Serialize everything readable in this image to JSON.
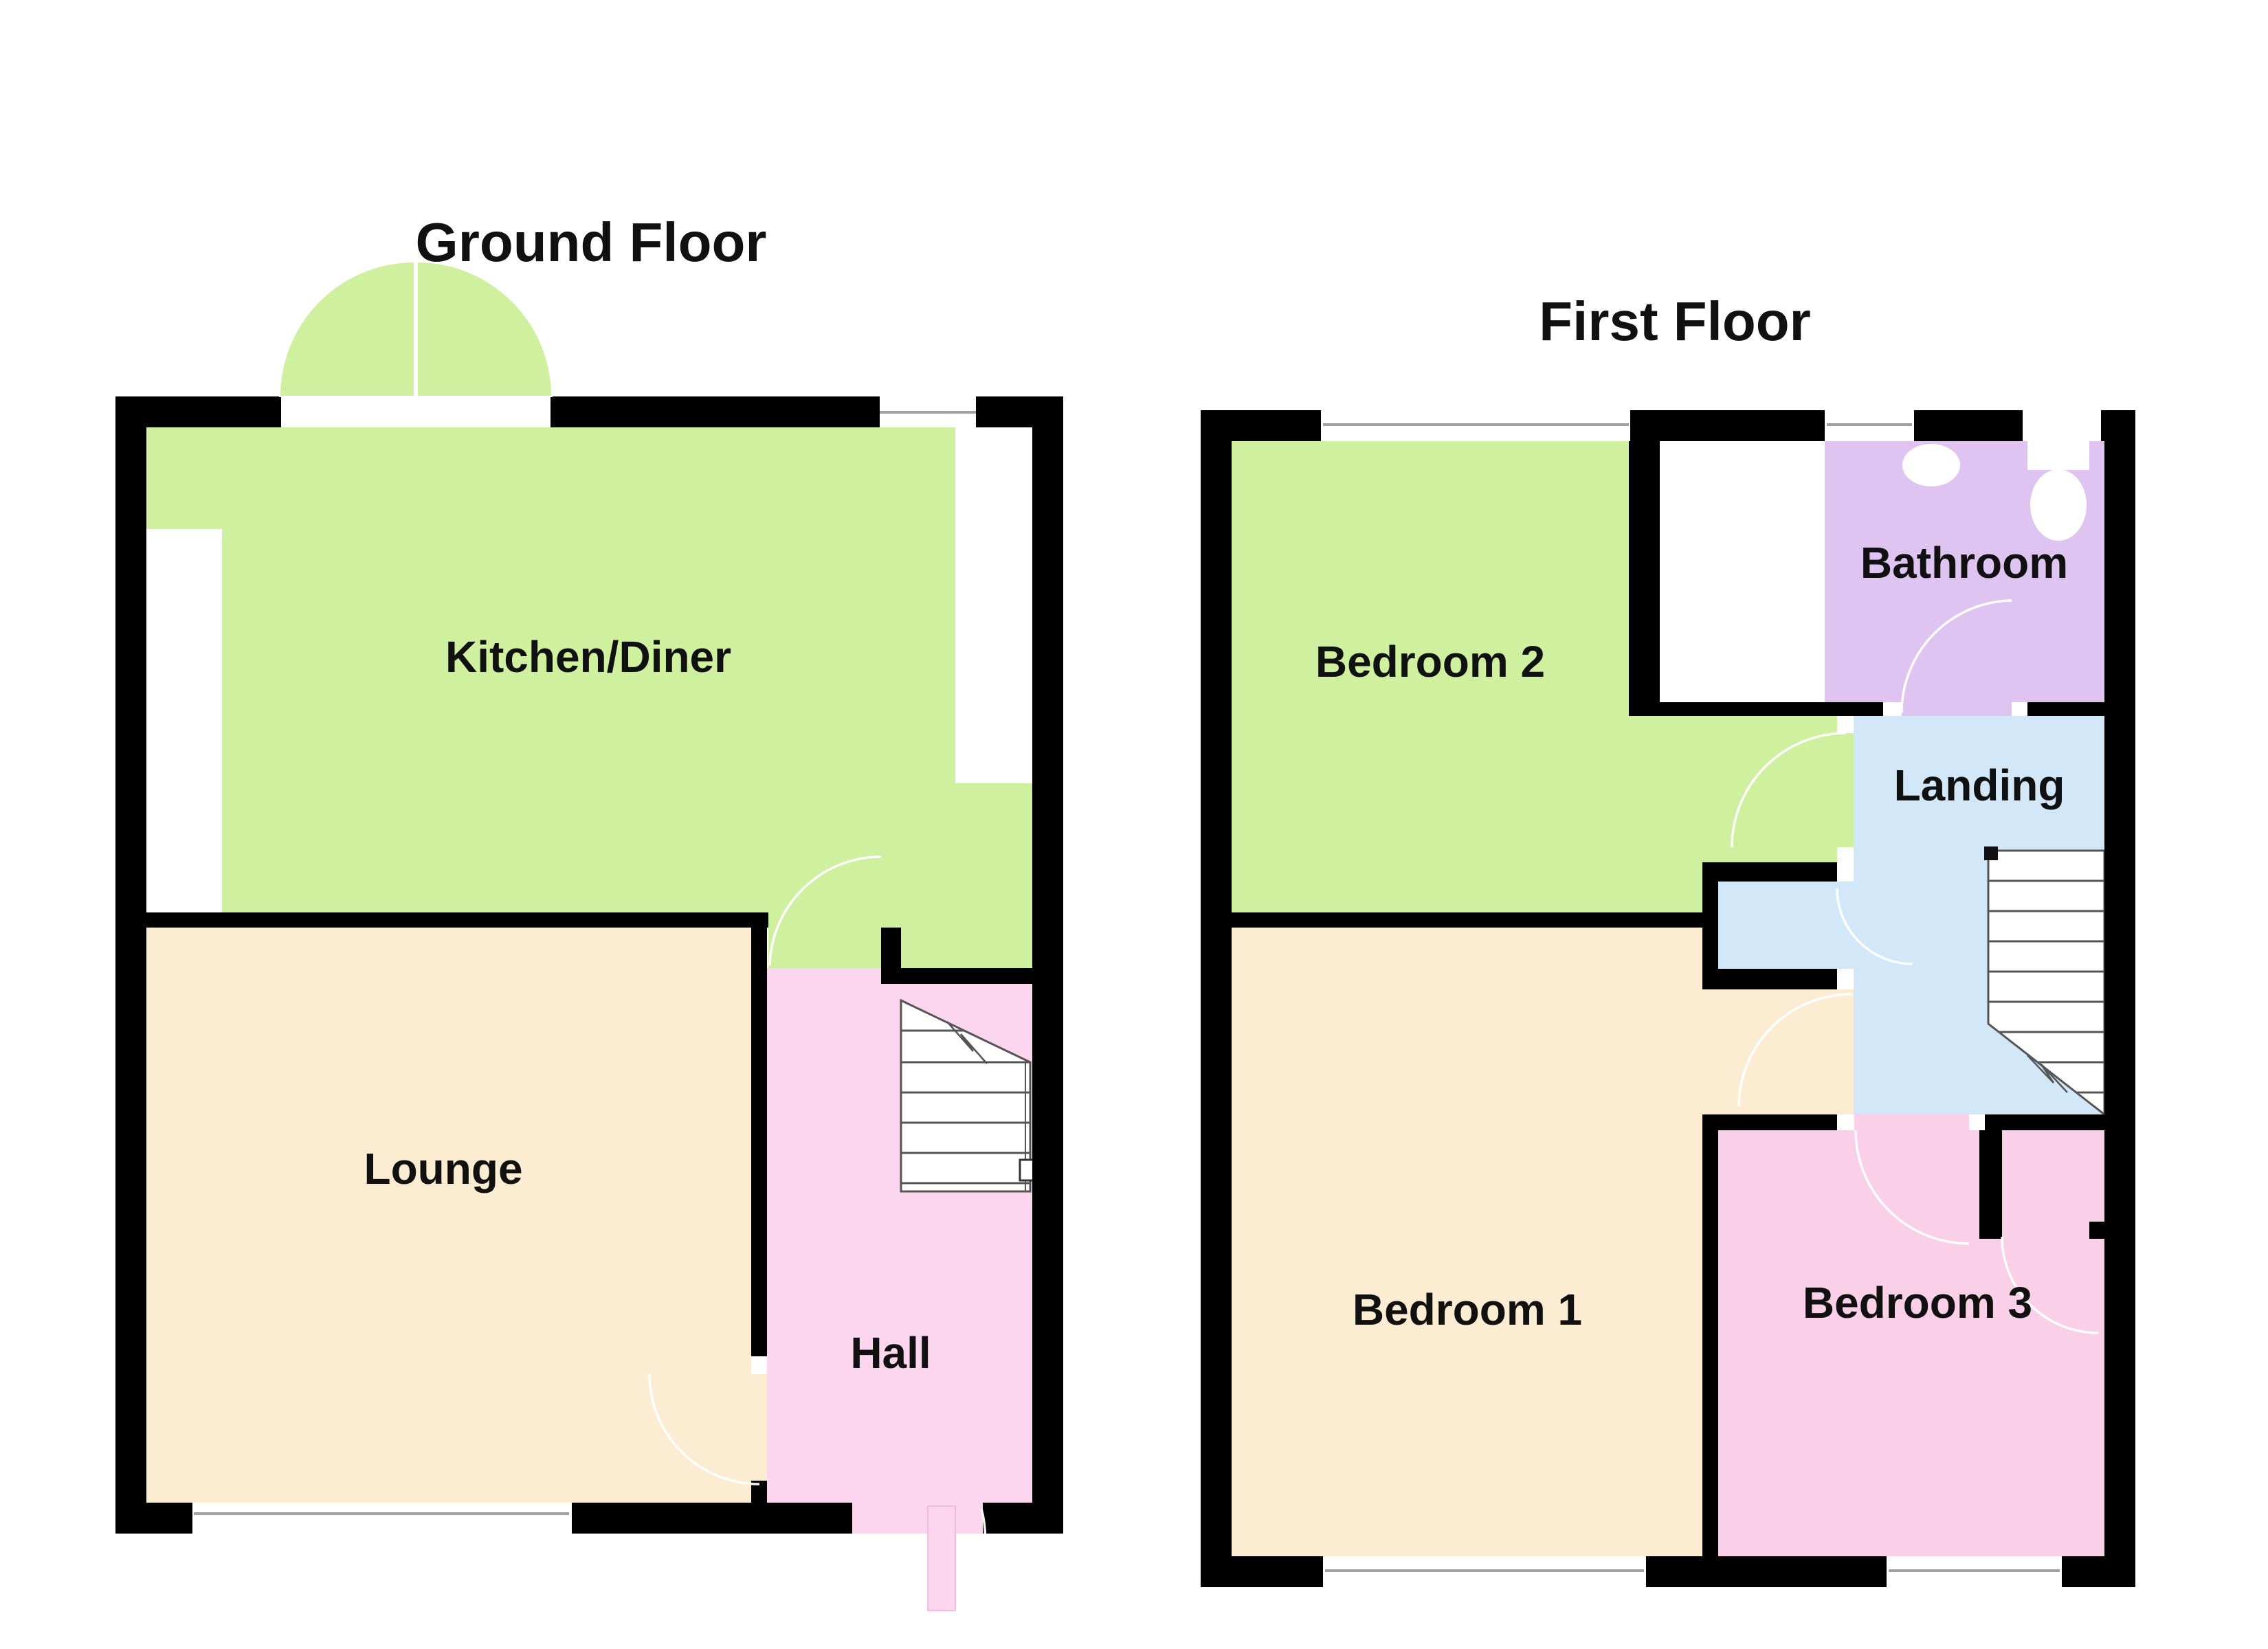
{
  "titles": {
    "ground": "Ground Floor",
    "first": "First Floor"
  },
  "rooms": {
    "kitchen": {
      "label": "Kitchen/Diner",
      "color": "#cff09e"
    },
    "lounge": {
      "label": "Lounge",
      "color": "#fcecd2"
    },
    "hall": {
      "label": "Hall",
      "color": "#fcd6ee"
    },
    "bedroom2": {
      "label": "Bedroom 2",
      "color": "#cff09e"
    },
    "bathroom": {
      "label": "Bathroom",
      "color": "#dfc3f0"
    },
    "landing": {
      "label": "Landing",
      "color": "#d2e7f8"
    },
    "bedroom1": {
      "label": "Bedroom 1",
      "color": "#fcecd2"
    },
    "bedroom3": {
      "label": "Bedroom 3",
      "color": "#f9d0e8"
    }
  },
  "colors": {
    "background": "#ffffff",
    "wall": "#000000",
    "door_arc": "#ffffff",
    "door_leaf_stroke": "#eebcdd",
    "stair_outline": "#555555",
    "window_glass": "#a0a0a0",
    "label_text": "#111111"
  }
}
